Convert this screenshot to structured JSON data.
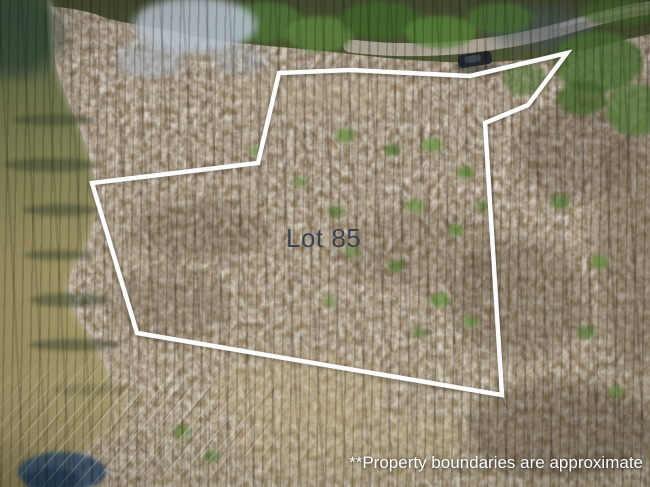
{
  "scene": {
    "type": "aerial-drone-photo",
    "features": [
      "lake-shoreline-left",
      "winter-bare-forest",
      "green-treeline-top",
      "gravel-road-top-right",
      "parked-vehicle-on-road",
      "marsh-bottom-left"
    ]
  },
  "lot_label": {
    "text": "Lot 85",
    "color": "#38424e"
  },
  "disclaimer": {
    "text": "**Property boundaries are approximate",
    "color": "#ffffff"
  },
  "boundary": {
    "color": "#ffffff",
    "stroke_width": "4.5",
    "points": "279,73 350,70 470,76 567,53 528,105 485,123 502,395 137,333 92,183 258,163"
  }
}
